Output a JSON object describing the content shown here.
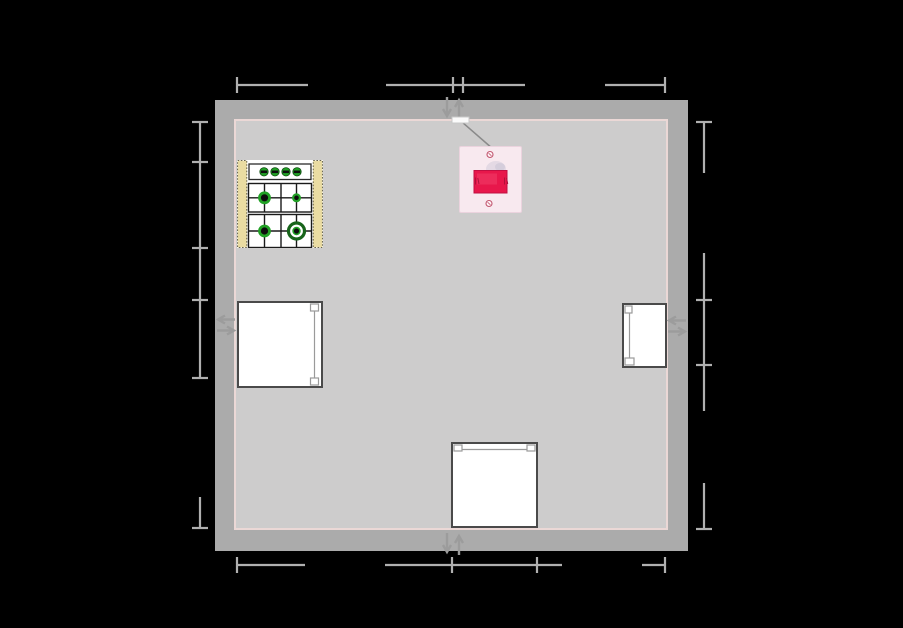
{
  "scene": {
    "width": 903,
    "height": 628
  },
  "colors": {
    "background": "#000000",
    "wall": "#ABABAB",
    "floor": "#CDCCCC",
    "baseboard": "#EBD8D6",
    "dimension": "#B0B0B0",
    "marker": "#9C9C9C",
    "furniture_border": "#4A4A4A",
    "furniture_fill": "#FFFFFF",
    "door_mark": "#9A9A9A",
    "stove_tan": "#EADCA2",
    "stove_green": "#21A125",
    "stove_green_dark": "#17641A",
    "switch_plate": "#F8E9EF",
    "switch_accent": "#E8174B",
    "connector": "#8A8A8A",
    "wall_box": "#FBFBFB"
  },
  "room": {
    "wall_rect": {
      "x": 215,
      "y": 100,
      "w": 473,
      "h": 451
    },
    "floor_rect": {
      "x": 234,
      "y": 119,
      "w": 434,
      "h": 411
    },
    "wall_thickness": 19
  },
  "dimension_lines": [
    {
      "name": "dimension-top",
      "orientation": "h",
      "pos": 85,
      "tick_len": 16,
      "segments": [
        [
          237,
          308
        ],
        [
          386,
          525
        ],
        [
          605,
          665
        ]
      ],
      "ticks": [
        237,
        453,
        463,
        665
      ]
    },
    {
      "name": "dimension-bottom",
      "orientation": "h",
      "pos": 565,
      "tick_len": 16,
      "segments": [
        [
          237,
          305
        ],
        [
          385,
          562
        ],
        [
          642,
          665
        ]
      ],
      "ticks": [
        237,
        452,
        537,
        665
      ]
    },
    {
      "name": "dimension-left",
      "orientation": "v",
      "pos": 200,
      "tick_len": 16,
      "segments": [
        [
          122,
          378
        ],
        [
          497,
          528
        ]
      ],
      "ticks": [
        122,
        162,
        248,
        300,
        378,
        528
      ]
    },
    {
      "name": "dimension-right",
      "orientation": "v",
      "pos": 704,
      "tick_len": 16,
      "segments": [
        [
          122,
          173
        ],
        [
          253,
          411
        ],
        [
          483,
          529
        ]
      ],
      "ticks": [
        122,
        300,
        365,
        529
      ]
    }
  ],
  "wall_markers": [
    {
      "name": "wall-marker-top",
      "cx": 453,
      "cy": 108,
      "orientation": "vertical"
    },
    {
      "name": "wall-marker-bottom",
      "cx": 453,
      "cy": 544,
      "orientation": "vertical"
    },
    {
      "name": "wall-marker-left",
      "cx": 226,
      "cy": 325,
      "orientation": "horizontal"
    },
    {
      "name": "wall-marker-right",
      "cx": 677,
      "cy": 326,
      "orientation": "horizontal"
    }
  ],
  "cabinets": [
    {
      "name": "appliance-left",
      "x": 237,
      "y": 301,
      "w": 86,
      "h": 87,
      "door_side": "right"
    },
    {
      "name": "appliance-right",
      "x": 622,
      "y": 303,
      "w": 45,
      "h": 65,
      "door_side": "left"
    },
    {
      "name": "appliance-bottom",
      "x": 451,
      "y": 442,
      "w": 87,
      "h": 86,
      "door_side": "top"
    }
  ],
  "stove": {
    "x": 237,
    "y": 160,
    "w": 86,
    "h": 88,
    "knob_count": 4,
    "burner_count": 4
  },
  "switch": {
    "plate": {
      "x": 459,
      "y": 146,
      "w": 63,
      "h": 67
    },
    "wall_box": {
      "x": 452,
      "y": 117,
      "w": 17,
      "h": 6
    },
    "connector": {
      "x1": 462,
      "y1": 122,
      "x2": 493,
      "y2": 149
    }
  }
}
